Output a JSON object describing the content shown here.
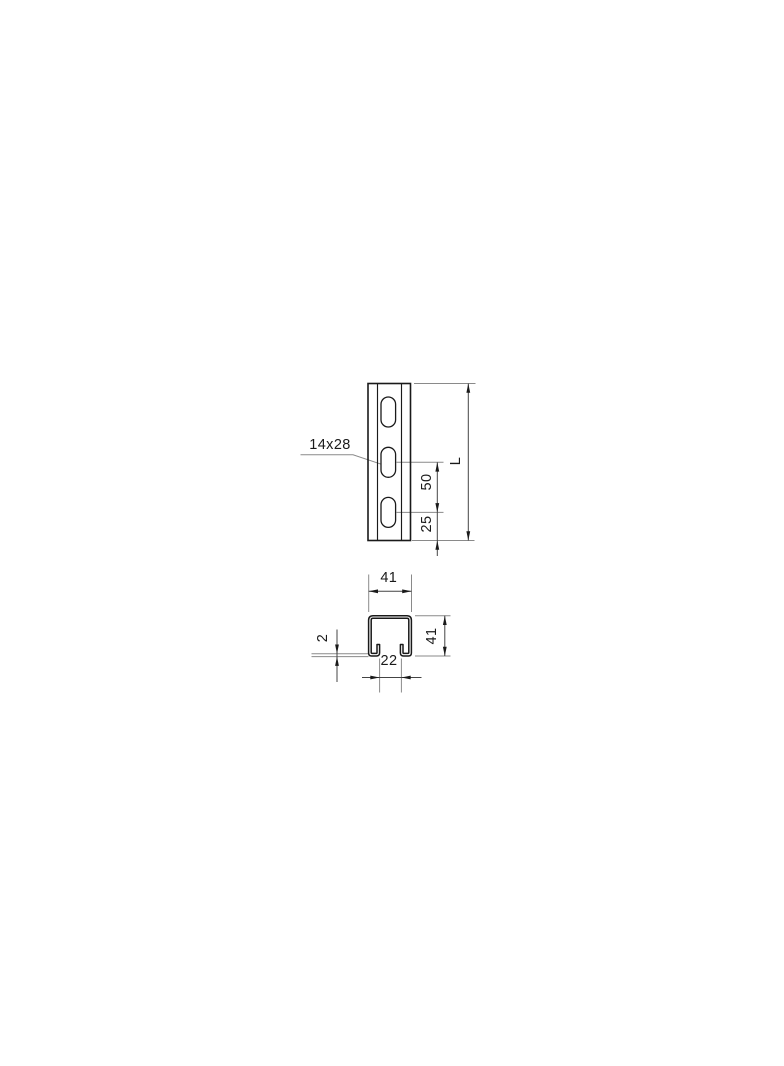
{
  "drawing": {
    "front_view": {
      "hole_size_label": "14x28",
      "hole_spacing": "50",
      "hole_end_offset": "25",
      "length_label": "L"
    },
    "section_view": {
      "outer_width": "41",
      "outer_height": "41",
      "slot_opening": "22",
      "wall_thickness": "2"
    }
  },
  "colors": {
    "object_line": "#1a1a1a",
    "thin_line": "#8a8a8a",
    "dim_line": "#444444",
    "background": "#ffffff"
  }
}
